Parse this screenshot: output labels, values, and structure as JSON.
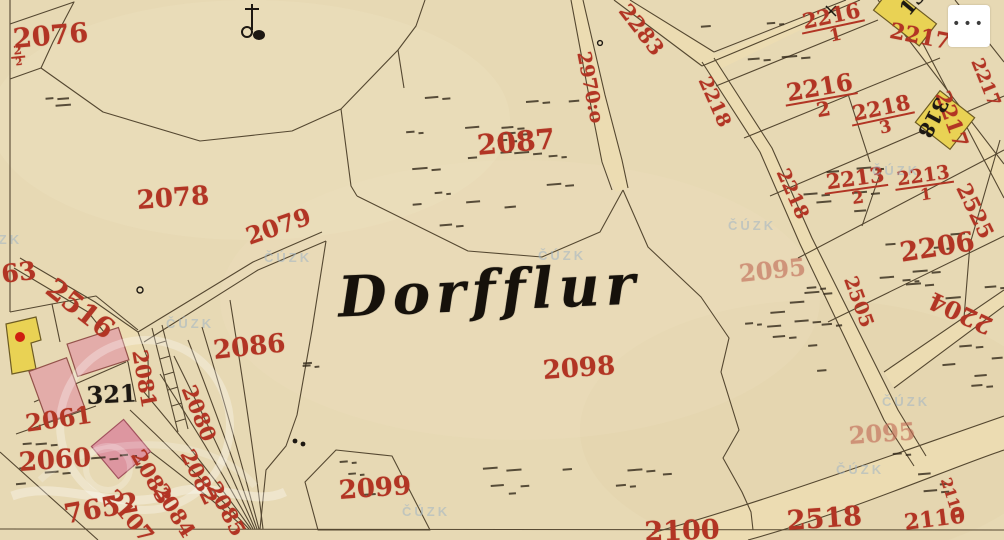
{
  "ui": {
    "menu_button": {
      "label": "•••",
      "icon": "ellipsis-icon"
    }
  },
  "map": {
    "place_name": "Dorfflur",
    "watermark_text": "ČÚZK",
    "colors": {
      "paper": "#e7d9b4",
      "ink": "#41341f",
      "red": "#b23524",
      "black_ink": "#1d1812",
      "road": "#ecdcb2",
      "yellow_building": "#e9d254",
      "pink_building": "#e3aca9",
      "pink_diamond": "#dd96a0",
      "building_dot": "#cf1f10",
      "watermark": "#9db3c6"
    },
    "watermarks": [
      {
        "x": -26,
        "y": 232
      },
      {
        "x": 166,
        "y": 316
      },
      {
        "x": 264,
        "y": 250
      },
      {
        "x": 538,
        "y": 248
      },
      {
        "x": 728,
        "y": 218
      },
      {
        "x": 402,
        "y": 504
      },
      {
        "x": 836,
        "y": 462
      },
      {
        "x": 882,
        "y": 394
      },
      {
        "x": 872,
        "y": 163
      }
    ],
    "parcel_labels": [
      {
        "text": "2076",
        "x": 12,
        "y": 26,
        "rot": -5,
        "size": 27
      },
      {
        "text": "2078",
        "x": 136,
        "y": 188,
        "rot": -4,
        "size": 26
      },
      {
        "text": "2079",
        "x": 243,
        "y": 226,
        "rot": -19,
        "size": 24
      },
      {
        "text": "2087",
        "x": 476,
        "y": 132,
        "rot": -5,
        "size": 28
      },
      {
        "text": "2086",
        "x": 212,
        "y": 338,
        "rot": -6,
        "size": 26
      },
      {
        "text": "2098",
        "x": 542,
        "y": 358,
        "rot": -4,
        "size": 26
      },
      {
        "text": "2099",
        "x": 338,
        "y": 478,
        "rot": -4,
        "size": 26
      },
      {
        "text": "2100",
        "x": 644,
        "y": 519,
        "rot": -2,
        "size": 27
      },
      {
        "text": "2518",
        "x": 786,
        "y": 508,
        "rot": -4,
        "size": 27
      },
      {
        "text": "2110",
        "x": 903,
        "y": 512,
        "rot": -7,
        "size": 22
      },
      {
        "text": "2110",
        "x": 952,
        "y": 476,
        "rot": 72,
        "size": 15
      },
      {
        "text": "2095",
        "x": 738,
        "y": 262,
        "rot": -6,
        "size": 24,
        "cls": "faded"
      },
      {
        "text": "2095",
        "x": 848,
        "y": 424,
        "rot": -4,
        "size": 24,
        "cls": "faded"
      },
      {
        "text": "2206",
        "x": 898,
        "y": 240,
        "rot": -9,
        "size": 27
      },
      {
        "text": "2204",
        "x": 986,
        "y": 338,
        "rot": 205,
        "size": 24
      },
      {
        "text": "2525",
        "x": 972,
        "y": 180,
        "rot": 64,
        "size": 21
      },
      {
        "text": "2505",
        "x": 858,
        "y": 274,
        "rot": 70,
        "size": 19
      },
      {
        "text": "2218",
        "x": 712,
        "y": 74,
        "rot": 66,
        "size": 19
      },
      {
        "text": "2218",
        "x": 790,
        "y": 166,
        "rot": 66,
        "size": 19
      },
      {
        "text": "2217",
        "x": 892,
        "y": 20,
        "rot": 11,
        "size": 22
      },
      {
        "text": "2217",
        "x": 952,
        "y": 88,
        "rot": 70,
        "size": 21
      },
      {
        "text": "2217",
        "x": 984,
        "y": 56,
        "rot": 68,
        "size": 18
      },
      {
        "text": "2283",
        "x": 632,
        "y": 0,
        "rot": 52,
        "size": 21
      },
      {
        "text": "2970:o",
        "x": 592,
        "y": 50,
        "rot": 79,
        "size": 19
      },
      {
        "text": "2516",
        "x": 58,
        "y": 274,
        "rot": 38,
        "size": 28
      },
      {
        "text": "63",
        "x": 0,
        "y": 262,
        "rot": -7,
        "size": 25
      },
      {
        "text": "2061",
        "x": 24,
        "y": 412,
        "rot": -8,
        "size": 24
      },
      {
        "text": "2060",
        "x": 18,
        "y": 450,
        "rot": -4,
        "size": 26
      },
      {
        "text": "7652",
        "x": 62,
        "y": 502,
        "rot": -10,
        "size": 27
      },
      {
        "text": "2107",
        "x": 118,
        "y": 486,
        "rot": 50,
        "size": 22
      },
      {
        "text": "2081",
        "x": 150,
        "y": 348,
        "rot": 80,
        "size": 21
      },
      {
        "text": "2080",
        "x": 198,
        "y": 382,
        "rot": 68,
        "size": 21
      },
      {
        "text": "2083",
        "x": 146,
        "y": 446,
        "rot": 60,
        "size": 21
      },
      {
        "text": "2082",
        "x": 196,
        "y": 446,
        "rot": 64,
        "size": 21
      },
      {
        "text": "2084",
        "x": 168,
        "y": 480,
        "rot": 58,
        "size": 21
      },
      {
        "text": "2085",
        "x": 222,
        "y": 478,
        "rot": 62,
        "size": 21
      }
    ],
    "fractions": [
      {
        "top": "2216",
        "bottom": "1",
        "x": 798,
        "y": 14,
        "rot": -12,
        "size": 21
      },
      {
        "top": "2216",
        "bottom": "2",
        "x": 782,
        "y": 84,
        "rot": -10,
        "size": 24
      },
      {
        "top": "2218",
        "bottom": "3",
        "x": 848,
        "y": 106,
        "rot": -12,
        "size": 21
      },
      {
        "top": "2213",
        "bottom": "2",
        "x": 822,
        "y": 174,
        "rot": -8,
        "size": 21
      },
      {
        "top": "2213",
        "bottom": "1",
        "x": 893,
        "y": 172,
        "rot": -8,
        "size": 19
      },
      {
        "top": "2",
        "bottom": "2",
        "x": 10,
        "y": 46,
        "rot": -6,
        "size": 12
      }
    ],
    "house_labels": [
      {
        "text": "321",
        "x": 86,
        "y": 384,
        "rot": -3,
        "size": 24
      },
      {
        "text": "13",
        "x": 896,
        "y": 6,
        "rot": -50,
        "size": 20
      },
      {
        "text": "318",
        "x": 952,
        "y": 104,
        "rot": 118,
        "size": 20
      }
    ]
  }
}
